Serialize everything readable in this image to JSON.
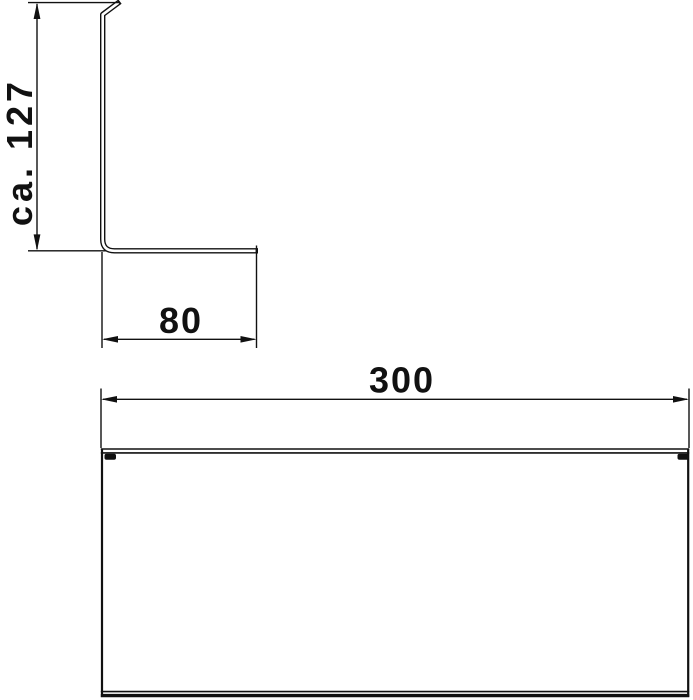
{
  "drawing": {
    "colors": {
      "line": "#111111",
      "bg": "#ffffff"
    },
    "dimensions": {
      "height": {
        "label": "ca. 127",
        "value": 127,
        "approximate": true,
        "orientation": "vertical"
      },
      "depth": {
        "label": "80",
        "value": 80,
        "approximate": false,
        "orientation": "horizontal"
      },
      "width": {
        "label": "300",
        "value": 300,
        "approximate": false,
        "orientation": "horizontal"
      }
    }
  }
}
